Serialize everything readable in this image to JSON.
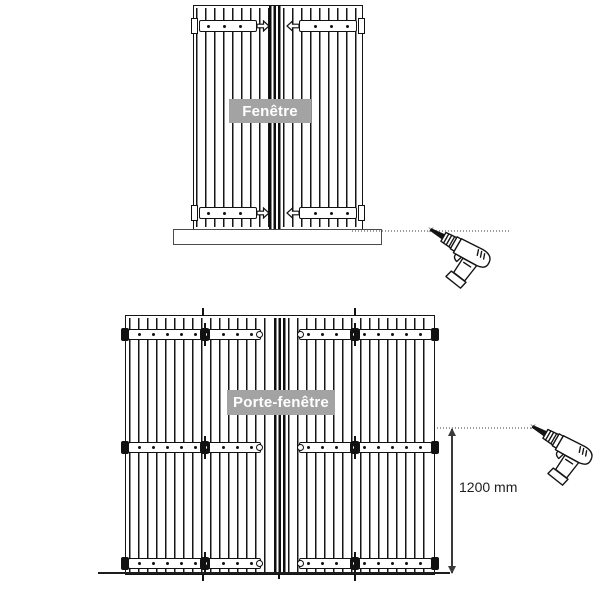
{
  "diagrams": {
    "window": {
      "label": "Fenêtre"
    },
    "french_door": {
      "label": "Porte-fenêtre",
      "height_dimension_label": "1200 mm"
    }
  },
  "icons": {
    "drill": "drill-icon",
    "drill_point_marker": "✕"
  },
  "colors": {
    "background": "#ffffff",
    "line": "#1a1a1a",
    "label_background": "#a3a3a3",
    "label_text": "#ffffff",
    "guide_dots": "#9c9c9c",
    "dimension_line": "#3a3a3a"
  }
}
